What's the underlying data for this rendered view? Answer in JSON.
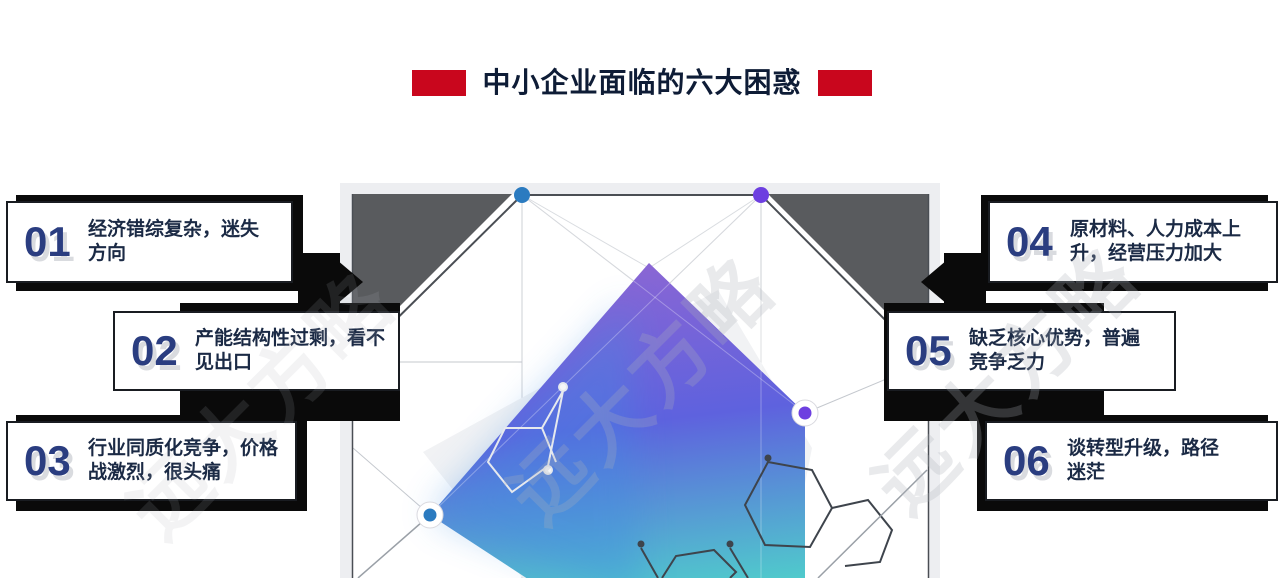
{
  "title": {
    "text": "中小企业面临的六大困惑",
    "accent_color": "#c9061d"
  },
  "watermark": {
    "text": "远大方略"
  },
  "cards": [
    {
      "num": "01",
      "text": "经济错综复杂，迷失方向"
    },
    {
      "num": "02",
      "text": "产能结构性过剩，看不见出口"
    },
    {
      "num": "03",
      "text": "行业同质化竞争，价格战激烈，很头痛"
    },
    {
      "num": "04",
      "text": "原材料、人力成本上升，经营压力加大"
    },
    {
      "num": "05",
      "text": "缺乏核心优势，普遍竞争乏力"
    },
    {
      "num": "06",
      "text": "谈转型升级，路径迷茫"
    }
  ],
  "colors": {
    "accent_red": "#c9061d",
    "title_navy": "#0e1c36",
    "card_number_blue": "#2a3d80",
    "card_text_navy": "#1b2a45",
    "shadow_black": "#0a0a0a",
    "frame_gray": "#edeef1",
    "corner_dark_gray": "#595b5e",
    "line_dark": "#4a4e54",
    "line_light": "#c4c8ce",
    "node_blue": "#2b7bc0",
    "node_purple": "#6d3fe0",
    "mountain_gradient_top": "#8a66d4",
    "mountain_gradient_mid": "#5e62de",
    "mountain_gradient_bottom": "#4ed5ca",
    "shadow_mountain_gray": "#f1f2f4",
    "watermark_gray": "#aeb2b9"
  }
}
